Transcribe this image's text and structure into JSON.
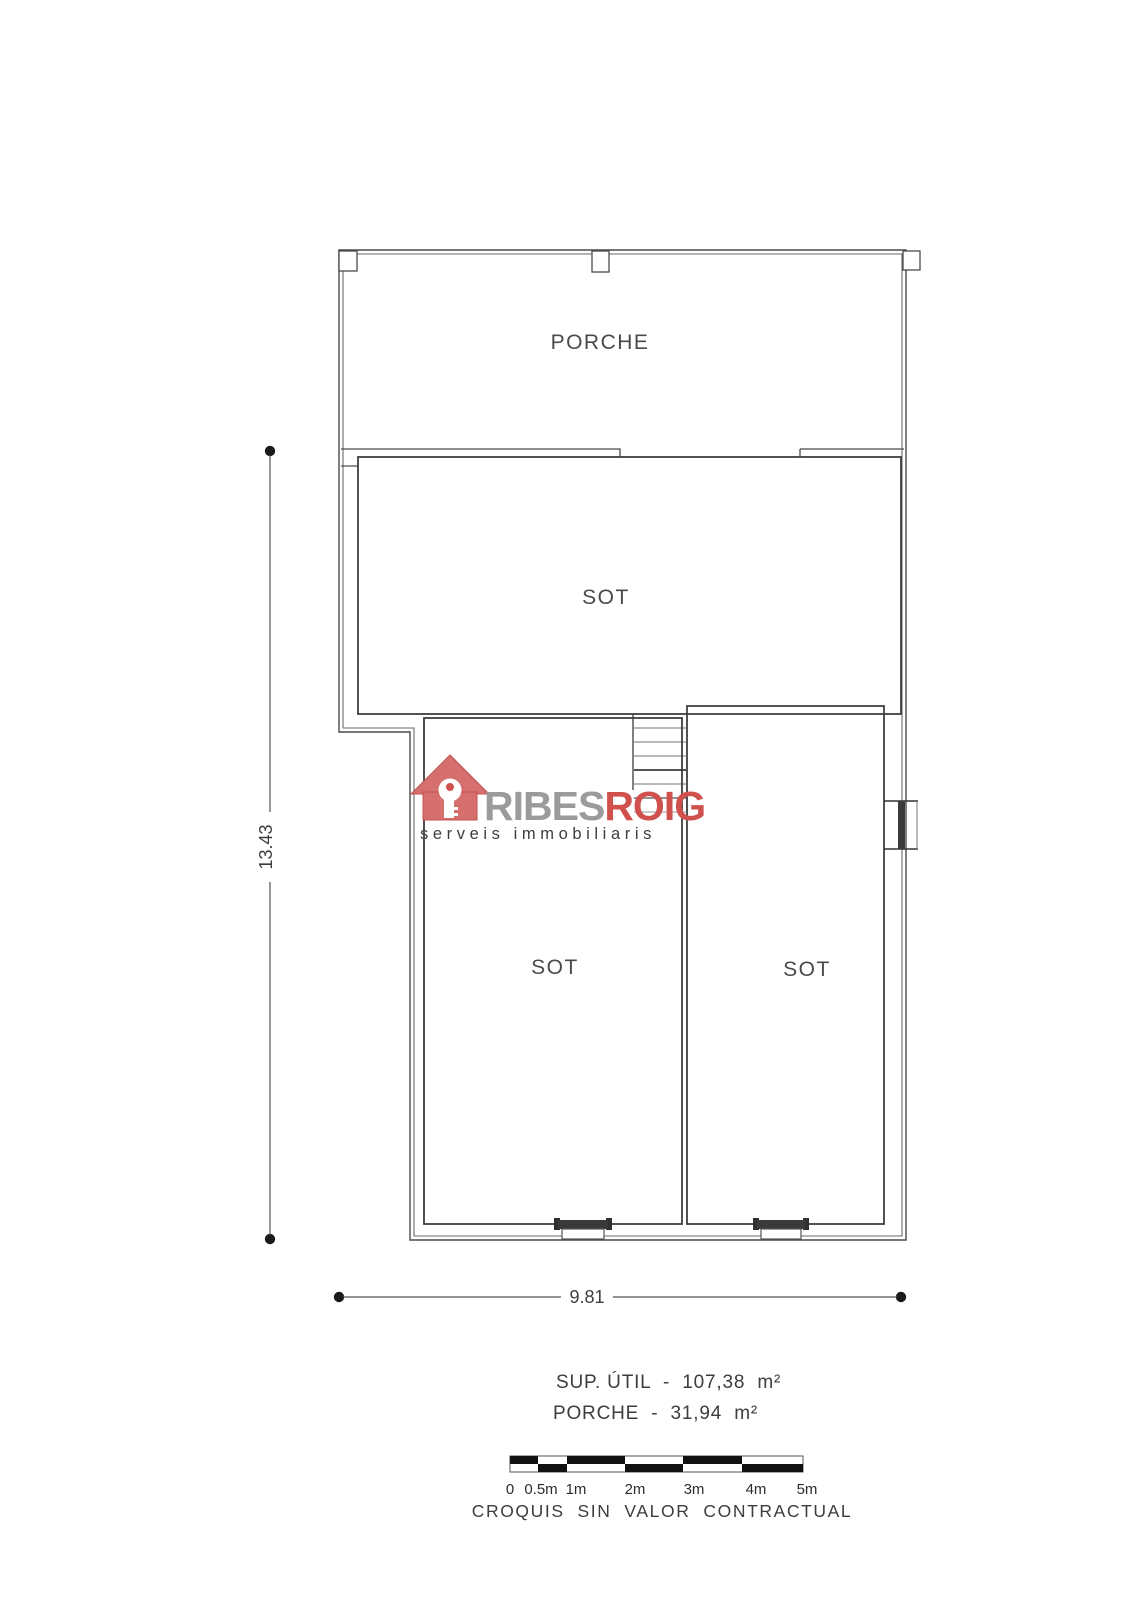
{
  "floor_plan": {
    "room_labels": {
      "porche": "PORCHE",
      "sot_upper": "SOT",
      "sot_lower_left": "SOT",
      "sot_lower_right": "SOT"
    },
    "dimensions": {
      "vertical": "13.43",
      "horizontal": "9.81"
    }
  },
  "logo": {
    "brand_part1": "RIBES",
    "brand_part2": "ROIG",
    "tagline": "serveis immobiliaris",
    "colors": {
      "red": "#d0504d",
      "salmon": "#d5706e",
      "gray": "#9b9b9b"
    }
  },
  "areas": {
    "line1": "SUP. ÚTIL  -  107,38  m²",
    "line2": "PORCHE  -  31,94  m²"
  },
  "scale_bar": {
    "labels": [
      "0",
      "0.5m",
      "1m",
      "2m",
      "3m",
      "4m",
      "5m"
    ]
  },
  "disclaimer": "CROQUIS  SIN  VALOR  CONTRACTUAL",
  "drawing_colors": {
    "wall": "#4a4a4a",
    "dimension": "#555555",
    "text": "#3d3d3d"
  }
}
